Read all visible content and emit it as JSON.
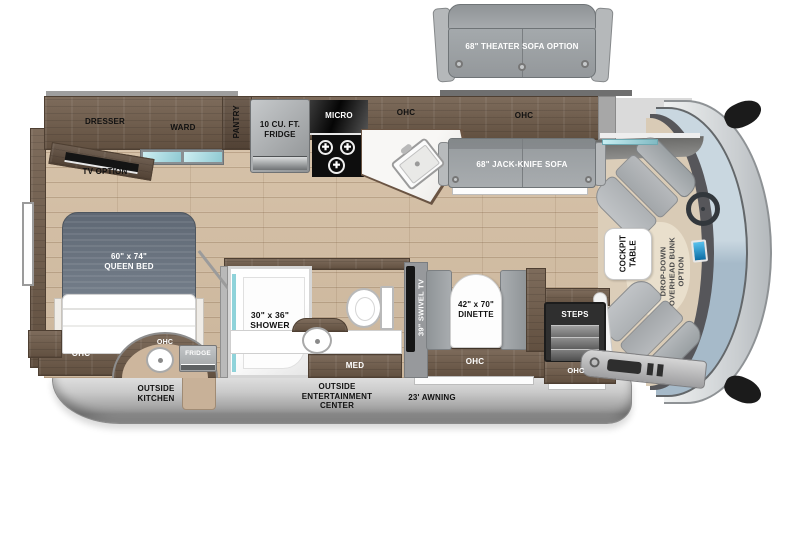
{
  "figure": "Class A motorhome floor plan, top view",
  "labels": {
    "theater_sofa": "68\" THEATER SOFA OPTION",
    "dresser": "DRESSER",
    "ward": "WARD",
    "pantry": "PANTRY",
    "tv_option": "TV OPTION",
    "fridge10_line1": "10 CU. FT.",
    "fridge10_line2": "FRIDGE",
    "micro": "MICRO",
    "ohc": "OHC",
    "jack_knife_sofa": "68\" JACK-KNIFE SOFA",
    "queen_bed_line1": "60\" x 74\"",
    "queen_bed_line2": "QUEEN BED",
    "shower_line1": "30\" x 36\"",
    "shower_line2": "SHOWER",
    "med": "MED",
    "swivel_tv": "39\" SWIVEL TV",
    "dinette_line1": "42\" x 70\"",
    "dinette_line2": "DINETTE",
    "steps": "STEPS",
    "fridge_outside": "FRIDGE",
    "outside_kitchen_line1": "OUTSIDE",
    "outside_kitchen_line2": "KITCHEN",
    "outside_ent_line1": "OUTSIDE",
    "outside_ent_line2": "ENTERTAINMENT",
    "outside_ent_line3": "CENTER",
    "awning": "23' AWNING",
    "cockpit_table_line1": "COCKPIT",
    "cockpit_table_line2": "TABLE",
    "bunk_line1": "DROP-DOWN",
    "bunk_line2": "OVERHEAD BUNK",
    "bunk_line3": "OPTION"
  },
  "colors": {
    "floor_wood": "#d2bda4",
    "cabinet_wood": "#6f5b49",
    "furniture_gray": "#a9adb0",
    "mattress_gray": "#6b7480",
    "counter_white": "#f5f4f1",
    "teal_accent": "#8fd3da",
    "skirt_gray": "#b9b9b9",
    "windshield_blue": "#b3c6d3",
    "cab_floor_tan": "#d9cbb6"
  }
}
